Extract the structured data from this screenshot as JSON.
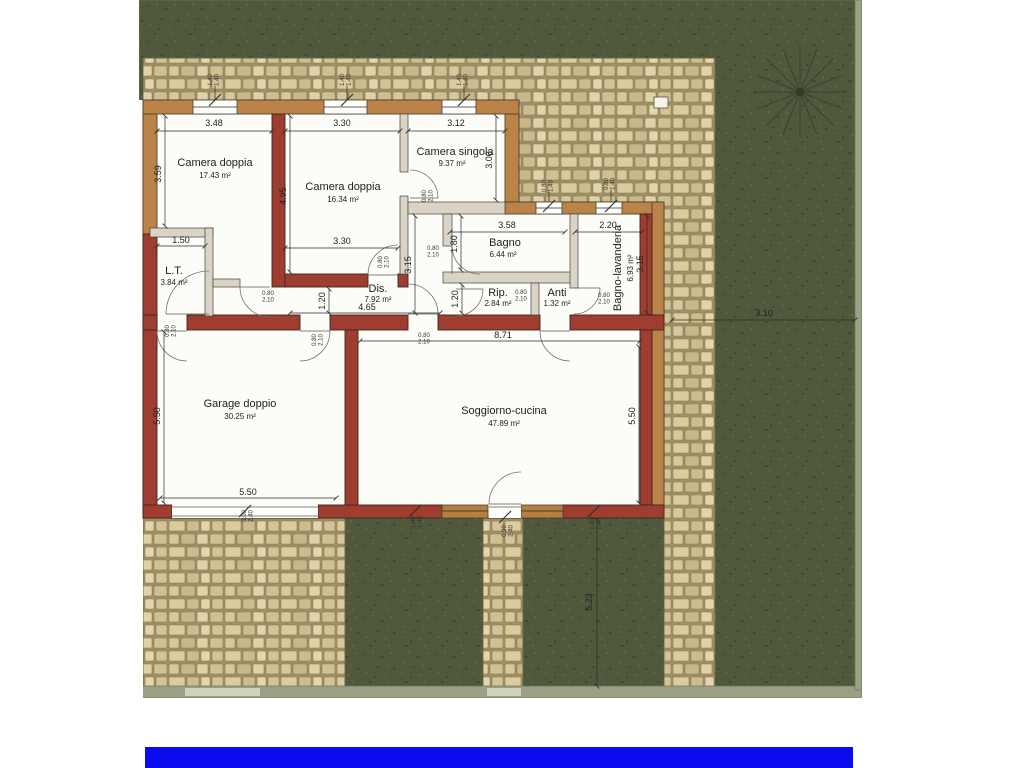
{
  "title": "Planimetria piano terra - villa con giardino",
  "rooms": [
    {
      "name": "Camera doppia",
      "area": "17.43 m²"
    },
    {
      "name": "Camera doppia",
      "area": "16.34 m²"
    },
    {
      "name": "Camera singola",
      "area": "9.37 m²"
    },
    {
      "name": "Bagno",
      "area": "6.44 m²"
    },
    {
      "name": "Bagno-lavanderia",
      "area": "6.93 m²"
    },
    {
      "name": "L.T.",
      "area": "3.84 m²"
    },
    {
      "name": "Dis.",
      "area": "7.92 m²",
      "length": "4.65"
    },
    {
      "name": "Rip.",
      "area": "2.84 m²"
    },
    {
      "name": "Anti",
      "area": "1.32 m²"
    },
    {
      "name": "Garage doppio",
      "area": "30.25 m²"
    },
    {
      "name": "Soggiorno-cucina",
      "area": "47.89 m²"
    }
  ],
  "dims": {
    "v348": "3.48",
    "v330": "3.30",
    "v312": "3.12",
    "v359": "3.59",
    "v495": "4.95",
    "v300": "3.00",
    "v150": "1.50",
    "v358": "3.58",
    "v220": "2.20",
    "v180": "1.80",
    "v315": "3.15",
    "v120": "1.20",
    "v465": "4.65",
    "v871": "8.71",
    "v550": "5.50",
    "v310": "3.10",
    "v523": "5.23"
  },
  "openings": {
    "door": {
      "w": "0.80",
      "h": "2.10"
    },
    "window": {
      "w": "1.40",
      "h": "1.40"
    },
    "small_window": {
      "w": "0.80",
      "h": "1.40"
    },
    "garage_door": {
      "w": "3.00",
      "h": "2.40"
    },
    "entrance_door": {
      "w": "0.90",
      "h": "2.40"
    }
  },
  "colors": {
    "lawn": "#4f5839",
    "stone": "#d6c69a",
    "wall_red": "#a03d31",
    "wall_tan": "#bb8347",
    "footer_bar": "#0b0bef"
  }
}
